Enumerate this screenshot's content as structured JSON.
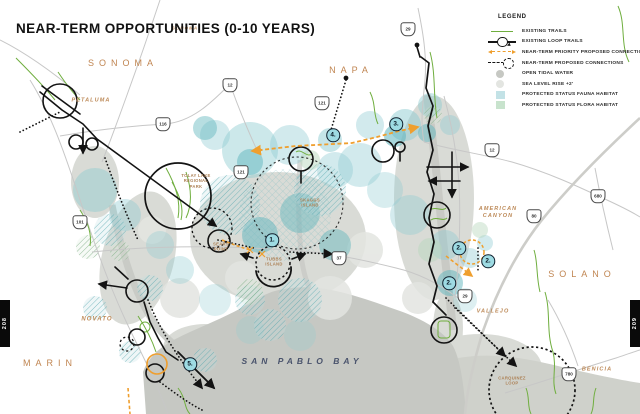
{
  "title": "NEAR-TERM OPPORTUNITIES (0-10 YEARS)",
  "page": {
    "left_tab_page": "208",
    "right_tab_page": "209"
  },
  "legend": {
    "title": "LEGEND",
    "items": [
      {
        "label": "EXISTING TRAILS",
        "swatch": "green-line"
      },
      {
        "label": "EXISTING LOOP TRAILS",
        "swatch": "loop-circle"
      },
      {
        "label": "NEAR-TERM PRIORITY PROPOSED CONNECTIONS",
        "swatch": "orange-dashed"
      },
      {
        "label": "NEAR-TERM PROPOSED CONNECTIONS",
        "swatch": "dashed-loop"
      },
      {
        "label": "OPEN TIDAL WATER",
        "swatch": "gray-circle"
      },
      {
        "label": "SEA LEVEL RISE +2'",
        "swatch": "light-gray-circle"
      },
      {
        "label": "PROTECTED STATUS FAUNA HABITAT",
        "swatch": "teal-square"
      },
      {
        "label": "PROTECTED STATUS FLORA HABITAT",
        "swatch": "green-square"
      }
    ]
  },
  "map": {
    "water_label": {
      "text": "SAN PABLO BAY",
      "x": 302,
      "y": 361
    },
    "regions": [
      {
        "text": "SONOMA",
        "x": 123,
        "y": 63
      },
      {
        "text": "NAPA",
        "x": 351,
        "y": 70
      },
      {
        "text": "MARIN",
        "x": 50,
        "y": 363
      },
      {
        "text": "SOLANO",
        "x": 582,
        "y": 274
      }
    ],
    "places": [
      {
        "text": "PETALUMA",
        "x": 91,
        "y": 101,
        "fs": 5.5
      },
      {
        "text": "NOVATO",
        "x": 97,
        "y": 320,
        "fs": 6
      },
      {
        "text": "VALLEJO",
        "x": 493,
        "y": 312,
        "fs": 5.5
      },
      {
        "text": "AMERICAN\nCANYON",
        "x": 498,
        "y": 213,
        "fs": 5.5
      },
      {
        "text": "BENICIA",
        "x": 597,
        "y": 370,
        "fs": 5.5
      },
      {
        "text": "SONOMA",
        "x": 185,
        "y": 28,
        "fs": 4.4
      }
    ],
    "sites": [
      {
        "text": "TOLAY LAKE\nREGIONAL\nPARK",
        "x": 196,
        "y": 181
      },
      {
        "text": "SEARS\nPOINT",
        "x": 221,
        "y": 247
      },
      {
        "text": "TUBBS\nISLAND",
        "x": 274,
        "y": 262
      },
      {
        "text": "SKAGGS\nISLAND",
        "x": 310,
        "y": 203
      },
      {
        "text": "CARQUINEZ\nLOOP",
        "x": 512,
        "y": 381
      }
    ],
    "markers": [
      {
        "n": "1.",
        "x": 272,
        "y": 240
      },
      {
        "n": "2.",
        "x": 459,
        "y": 248
      },
      {
        "n": "2.",
        "x": 488,
        "y": 261
      },
      {
        "n": "2.",
        "x": 449,
        "y": 283
      },
      {
        "n": "3.",
        "x": 396,
        "y": 124
      },
      {
        "n": "4.",
        "x": 333,
        "y": 135
      },
      {
        "n": "5.",
        "x": 190,
        "y": 364
      }
    ],
    "highway_shields": [
      {
        "n": "12",
        "x": 230,
        "y": 85
      },
      {
        "n": "116",
        "x": 163,
        "y": 124
      },
      {
        "n": "121",
        "x": 322,
        "y": 103
      },
      {
        "n": "29",
        "x": 408,
        "y": 29
      },
      {
        "n": "101",
        "x": 80,
        "y": 222
      },
      {
        "n": "121",
        "x": 241,
        "y": 172
      },
      {
        "n": "37",
        "x": 339,
        "y": 258
      },
      {
        "n": "12",
        "x": 492,
        "y": 150
      },
      {
        "n": "80",
        "x": 534,
        "y": 216
      },
      {
        "n": "680",
        "x": 598,
        "y": 196
      },
      {
        "n": "29",
        "x": 465,
        "y": 296
      },
      {
        "n": "780",
        "x": 569,
        "y": 374
      }
    ]
  },
  "colors": {
    "accent_orange": "#ef9f2e",
    "trail_green": "#6fae3e",
    "bay_gray": "#c6c8c3",
    "marsh_gray": "#d9dbd6",
    "fauna_teal": "#8ecbd1",
    "flora_green": "#b9d8bd",
    "sea_level_rise_gray": "#e3e5e1",
    "label_brown": "#bd8a58",
    "bay_label_navy": "#49536c",
    "marker_fill": "#9edbe3"
  }
}
